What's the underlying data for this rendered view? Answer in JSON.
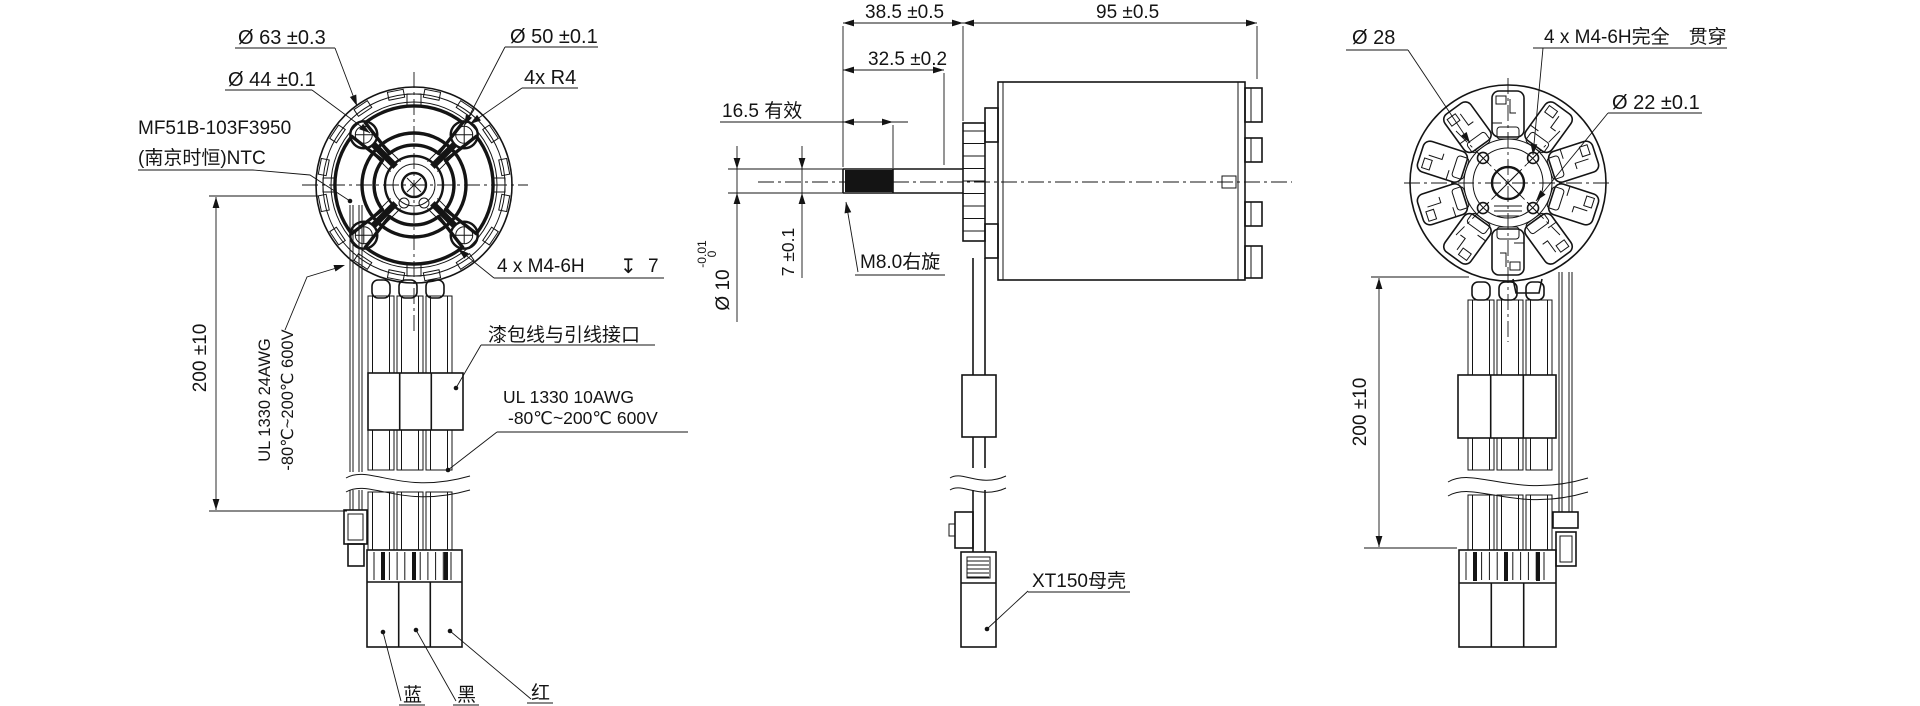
{
  "drawing": {
    "front": {
      "dim_d63": "Ø 63  ±0.3",
      "dim_d50": "Ø 50  ±0.1",
      "dim_d44": "Ø 44  ±0.1",
      "dim_4xr4": "4x R4",
      "ntc_line1": "MF51B-103F3950",
      "ntc_line2": "(南京时恒)NTC",
      "dim_4xm4": "4 x M4-6H",
      "depth_symbol": "↧",
      "depth_value": "7",
      "wire_interface_label": "漆包线与引线接口",
      "lead_spec_line1": "UL 1330 10AWG",
      "lead_spec_line2": "-80℃~200℃ 600V",
      "ntc_spec_line1": "UL 1330 24AWG",
      "ntc_spec_line2": "-80℃~200℃ 600V",
      "dim_wire_length": "200  ±10",
      "wire_blue": "蓝",
      "wire_black": "黑",
      "wire_red": "红"
    },
    "side": {
      "dim_shaft_total": "38.5  ±0.5",
      "dim_body_length": "95  ±0.5",
      "dim_shank": "32.5  ±0.2",
      "dim_thread_effective": "16.5  有效",
      "dim_shaft_dia": "Ø 10",
      "dim_shaft_dia_tol_upper": "0",
      "dim_shaft_dia_tol_lower": "-0.01",
      "dim_flat": "7  ±0.1",
      "thread_label": "M8.0右旋",
      "connector_label": "XT150母壳"
    },
    "rear": {
      "dim_d28": "Ø 28",
      "dim_4xm4_through": "4 x M4-6H完全　贯穿",
      "dim_d22": "Ø 22  ±0.1",
      "dim_wire_length": "200  ±10"
    }
  }
}
